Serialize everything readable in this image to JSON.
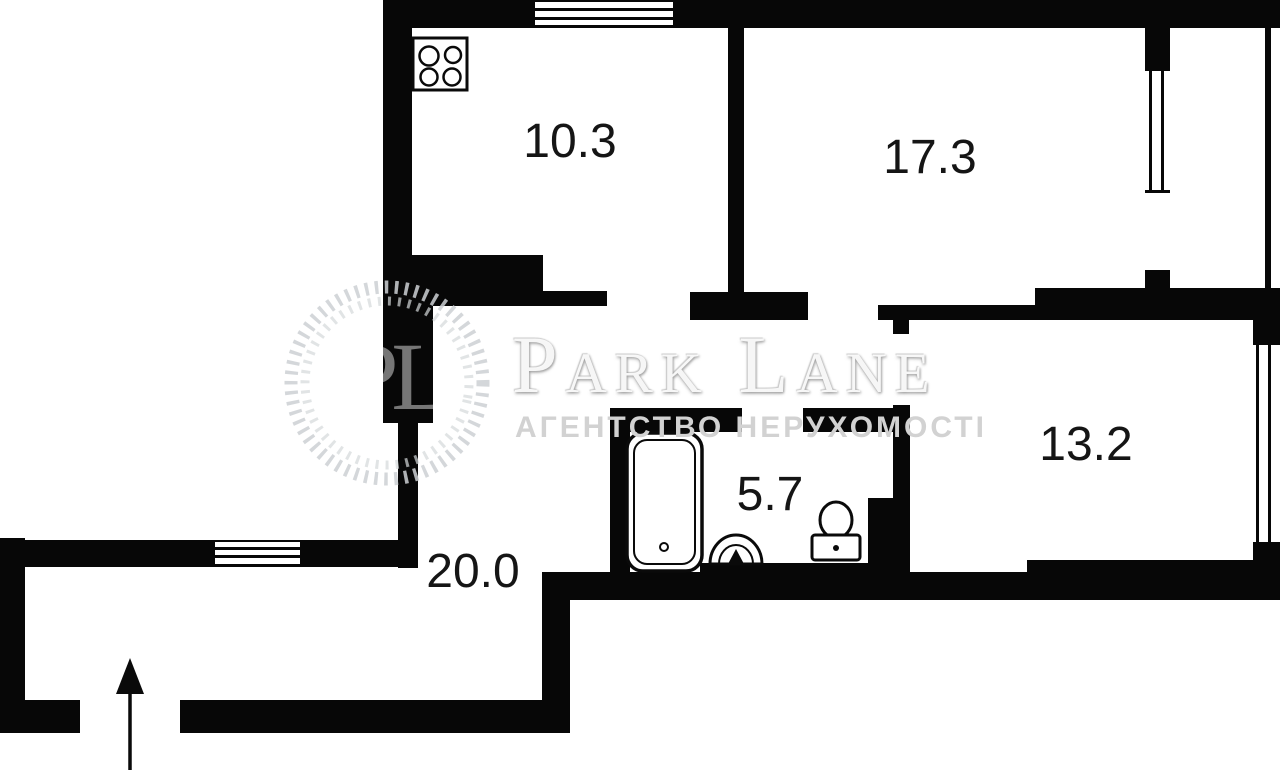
{
  "plan": {
    "rooms": [
      {
        "id": "kitchen",
        "area": "10.3"
      },
      {
        "id": "living-room",
        "area": "17.3"
      },
      {
        "id": "bedroom",
        "area": "13.2"
      },
      {
        "id": "bathroom",
        "area": "5.7"
      },
      {
        "id": "hallway",
        "area": "20.0"
      }
    ]
  },
  "watermark": {
    "monogram": "PL",
    "brand": "Park Lane",
    "subtitle": "АГЕНТСТВО НЕРУХОМОСТІ"
  }
}
